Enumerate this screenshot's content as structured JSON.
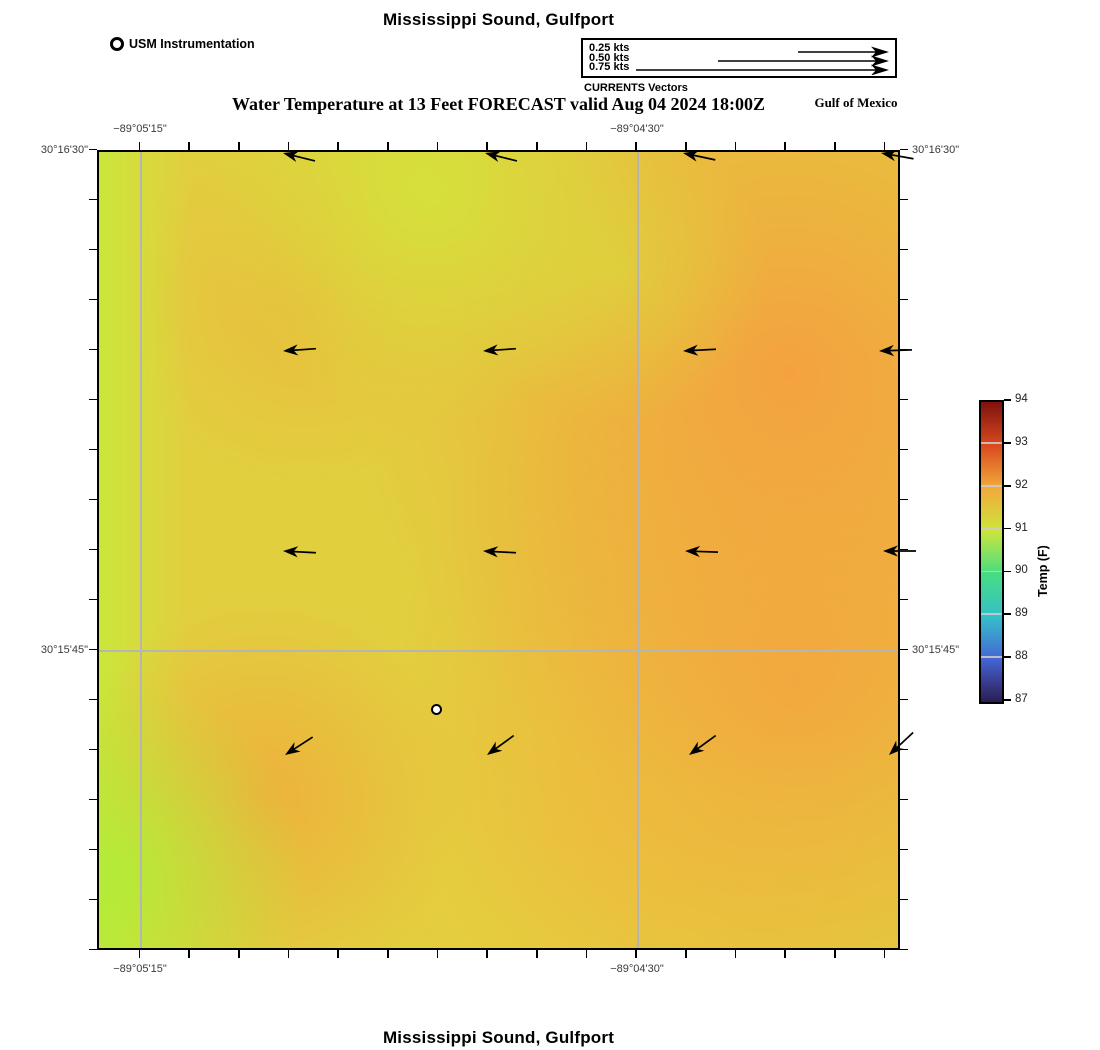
{
  "header": {
    "title": "Mississippi Sound, Gulfport",
    "instrumentation_label": "USM Instrumentation",
    "region_label": "Gulf of Mexico",
    "subtitle": "Water Temperature at 13 Feet FORECAST valid Aug 04 2024 18:00Z"
  },
  "legend": {
    "caption": "CURRENTS Vectors",
    "scale": [
      {
        "label": "0.25 kts",
        "length_px": 90
      },
      {
        "label": "0.50 kts",
        "length_px": 170
      },
      {
        "label": "0.75 kts",
        "length_px": 252
      }
    ]
  },
  "footer": {
    "title": "Mississippi Sound, Gulfport"
  },
  "chart_data": {
    "type": "heatmap",
    "title": "Mississippi Sound, Gulfport",
    "subtitle": "Water Temperature at 13 Feet FORECAST valid Aug 04 2024 18:00Z",
    "x_axis": {
      "labels": [
        "−89°05'15\"",
        "−89°04'30\""
      ],
      "label_px": [
        140,
        637
      ],
      "tick_interval_arcsec": 4.5,
      "tick_count": 16
    },
    "y_axis": {
      "labels": [
        "30°16'30\"",
        "30°15'45\""
      ],
      "label_px": [
        150,
        650
      ],
      "tick_interval_arcsec": 4.5,
      "tick_count": 17
    },
    "colorbar": {
      "label": "Temp (F)",
      "min": 87,
      "max": 94,
      "ticks": [
        87,
        88,
        89,
        90,
        91,
        92,
        93,
        94
      ],
      "colormap": "turbo-like (dark purple → blue → cyan → green → yellow → orange → dark red)"
    },
    "temperature_field_estimate_F": {
      "note": "5x5 grid sampled left→right, top→bottom across map, read from colorbar",
      "values": [
        [
          91.0,
          91.6,
          91.1,
          91.9,
          92.2
        ],
        [
          91.1,
          91.7,
          91.3,
          92.1,
          92.3
        ],
        [
          91.0,
          91.3,
          91.5,
          92.2,
          92.2
        ],
        [
          90.9,
          91.8,
          91.4,
          92.0,
          92.1
        ],
        [
          90.6,
          91.1,
          91.3,
          91.7,
          92.0
        ]
      ]
    },
    "station": {
      "name": "USM Instrumentation",
      "x_px": 437,
      "y_px": 710
    },
    "vectors_note": "current vectors ~0.09 kts; rot = screen rotation of a left-pointing arrow, deg (+=up)",
    "vectors": [
      {
        "x": 283,
        "y": 153,
        "rot": 14,
        "dir": "W"
      },
      {
        "x": 485,
        "y": 153,
        "rot": 14,
        "dir": "W"
      },
      {
        "x": 683,
        "y": 153,
        "rot": 12,
        "dir": "W"
      },
      {
        "x": 881,
        "y": 153,
        "rot": 10,
        "dir": "W"
      },
      {
        "x": 283,
        "y": 351,
        "rot": -4,
        "dir": "W"
      },
      {
        "x": 483,
        "y": 351,
        "rot": -4,
        "dir": "W"
      },
      {
        "x": 683,
        "y": 351,
        "rot": -3,
        "dir": "W"
      },
      {
        "x": 879,
        "y": 351,
        "rot": -2,
        "dir": "W"
      },
      {
        "x": 283,
        "y": 551,
        "rot": 3,
        "dir": "W"
      },
      {
        "x": 483,
        "y": 551,
        "rot": 3,
        "dir": "W"
      },
      {
        "x": 685,
        "y": 551,
        "rot": 2,
        "dir": "W"
      },
      {
        "x": 883,
        "y": 551,
        "rot": 0,
        "dir": "W"
      },
      {
        "x": 285,
        "y": 755,
        "rot": -33,
        "dir": "SW"
      },
      {
        "x": 487,
        "y": 755,
        "rot": -36,
        "dir": "SW"
      },
      {
        "x": 689,
        "y": 755,
        "rot": -36,
        "dir": "SW"
      },
      {
        "x": 889,
        "y": 755,
        "rot": -43,
        "dir": "SW"
      }
    ]
  }
}
